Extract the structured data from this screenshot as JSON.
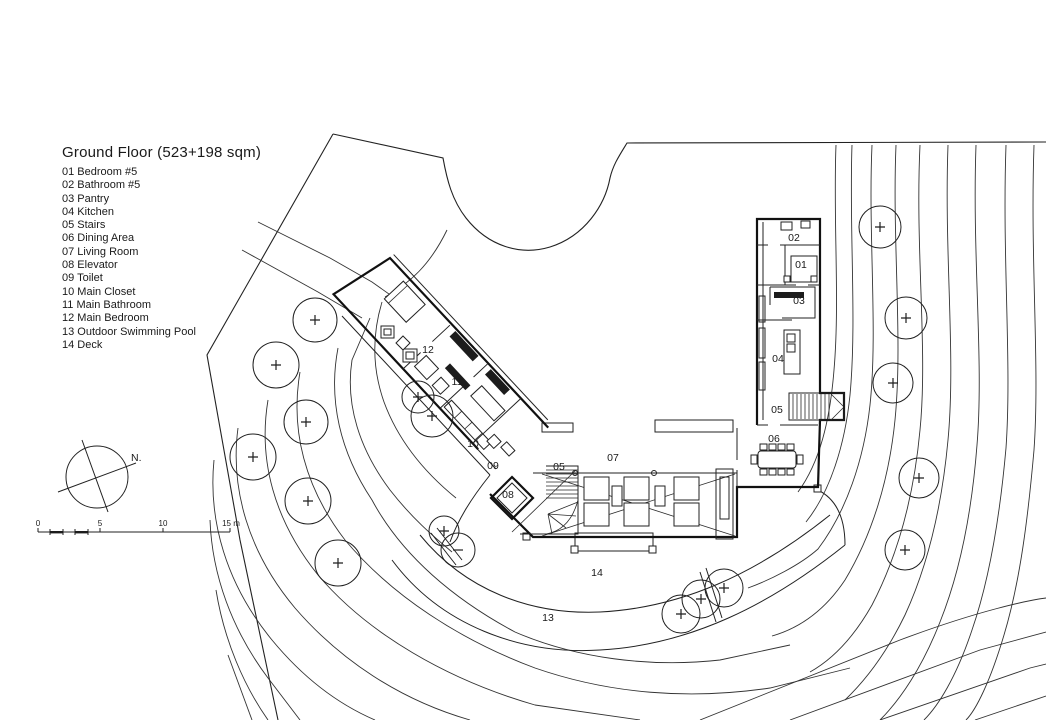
{
  "title": "Ground Floor (523+198 sqm)",
  "legend": {
    "items": [
      "01 Bedroom #5",
      "02 Bathroom #5",
      "03 Pantry",
      "04 Kitchen",
      "05 Stairs",
      "06 Dining Area",
      "07 Living Room",
      "08 Elevator",
      "09 Toilet",
      "10 Main Closet",
      "11 Main Bathroom",
      "12 Main Bedroom",
      "13 Outdoor Swimming Pool",
      "14 Deck"
    ]
  },
  "compass": {
    "label": "N."
  },
  "scale_bar": {
    "labels": [
      "0",
      "5",
      "10",
      "15 m"
    ]
  },
  "plan_labels": [
    {
      "text": "02",
      "x": 794,
      "y": 241
    },
    {
      "text": "01",
      "x": 801,
      "y": 268
    },
    {
      "text": "03",
      "x": 799,
      "y": 304
    },
    {
      "text": "04",
      "x": 778,
      "y": 362
    },
    {
      "text": "05",
      "x": 777,
      "y": 413
    },
    {
      "text": "06",
      "x": 774,
      "y": 442
    },
    {
      "text": "07",
      "x": 613,
      "y": 461
    },
    {
      "text": "05",
      "x": 559,
      "y": 470
    },
    {
      "text": "08",
      "x": 508,
      "y": 498
    },
    {
      "text": "09",
      "x": 493,
      "y": 469
    },
    {
      "text": "10",
      "x": 473,
      "y": 447
    },
    {
      "text": "11",
      "x": 457,
      "y": 385
    },
    {
      "text": "12",
      "x": 428,
      "y": 353
    },
    {
      "text": "13",
      "x": 548,
      "y": 621
    },
    {
      "text": "14",
      "x": 597,
      "y": 576
    }
  ],
  "trees": [
    {
      "x": 315,
      "y": 320,
      "r": 22,
      "mark": "+"
    },
    {
      "x": 276,
      "y": 365,
      "r": 23,
      "mark": "+"
    },
    {
      "x": 306,
      "y": 422,
      "r": 22,
      "mark": "+"
    },
    {
      "x": 253,
      "y": 457,
      "r": 23,
      "mark": "+"
    },
    {
      "x": 308,
      "y": 501,
      "r": 23,
      "mark": "+"
    },
    {
      "x": 338,
      "y": 563,
      "r": 23,
      "mark": "+"
    },
    {
      "x": 418,
      "y": 397,
      "r": 16,
      "mark": "+"
    },
    {
      "x": 432,
      "y": 416,
      "r": 21,
      "mark": "+"
    },
    {
      "x": 444,
      "y": 531,
      "r": 15,
      "mark": "+"
    },
    {
      "x": 458,
      "y": 550,
      "r": 17,
      "mark": "-"
    },
    {
      "x": 681,
      "y": 614,
      "r": 19,
      "mark": "+"
    },
    {
      "x": 701,
      "y": 599,
      "r": 19,
      "mark": "+"
    },
    {
      "x": 724,
      "y": 588,
      "r": 19,
      "mark": "+"
    },
    {
      "x": 880,
      "y": 227,
      "r": 21,
      "mark": "+"
    },
    {
      "x": 906,
      "y": 318,
      "r": 21,
      "mark": "+"
    },
    {
      "x": 893,
      "y": 383,
      "r": 20,
      "mark": "+"
    },
    {
      "x": 919,
      "y": 478,
      "r": 20,
      "mark": "+"
    },
    {
      "x": 905,
      "y": 550,
      "r": 20,
      "mark": "+"
    }
  ],
  "colors": {
    "line": "#1f1f1f",
    "background": "#ffffff"
  }
}
